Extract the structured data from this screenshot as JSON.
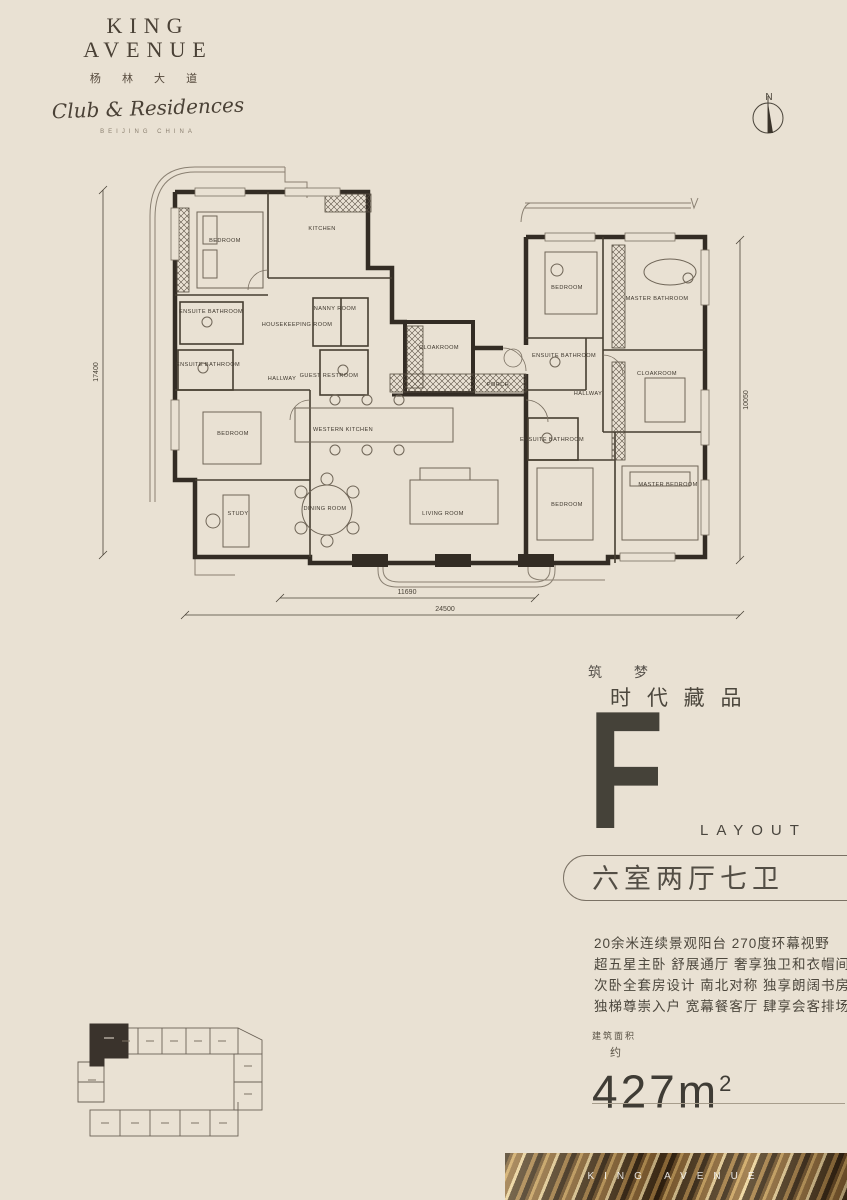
{
  "brand": {
    "name_line1": "KING",
    "name_line2": "AVENUE",
    "name_cn": "杨 林 大 道",
    "script_name": "Club & Residences",
    "location": "BEIJING CHINA"
  },
  "compass": {
    "label": "N"
  },
  "floor_plan": {
    "rooms": [
      {
        "label": "BEDROOM"
      },
      {
        "label": "KITCHEN"
      },
      {
        "label": "ENSUITE BATHROOM"
      },
      {
        "label": "NANNY ROOM"
      },
      {
        "label": "HOUSEKEEPING ROOM"
      },
      {
        "label": "ENSUITE BATHROOM"
      },
      {
        "label": "HALLWAY"
      },
      {
        "label": "GUEST RESTROOM"
      },
      {
        "label": "BEDROOM"
      },
      {
        "label": "STUDY"
      },
      {
        "label": "WESTERN KITCHEN"
      },
      {
        "label": "DINING ROOM"
      },
      {
        "label": "LIVING ROOM"
      },
      {
        "label": "CLOAKROOM"
      },
      {
        "label": "PORCH"
      },
      {
        "label": "BEDROOM"
      },
      {
        "label": "MASTER BATHROOM"
      },
      {
        "label": "ENSUITE BATHROOM"
      },
      {
        "label": "HALLWAY"
      },
      {
        "label": "CLOAKROOM"
      },
      {
        "label": "ENSUITE BATHROOM"
      },
      {
        "label": "BEDROOM"
      },
      {
        "label": "MASTER BEDROOM"
      }
    ],
    "dimensions": {
      "left": "17400",
      "right": "10050",
      "bottom_inner": "11690",
      "bottom_outer": "24500"
    }
  },
  "layout_info": {
    "tagline_left": "筑 梦",
    "tagline_right": "时 代 藏 品",
    "type_letter": "F",
    "type_label": "LAYOUT",
    "config": "六室两厅七卫",
    "features": [
      "20余米连续景观阳台  270度环幕视野",
      "超五星主卧  舒展通厅  奢享独卫和衣帽间",
      "次卧全套房设计 南北对称 独享朗阔书房",
      "独梯尊崇入户  宽幕餐客厅  肆享会客排场"
    ],
    "area_label": "建筑面积",
    "area_approx": "约",
    "area_value": "427",
    "area_unit": "m",
    "area_sup": "2"
  },
  "footer_banner": {
    "text": "KING AVENUE"
  }
}
